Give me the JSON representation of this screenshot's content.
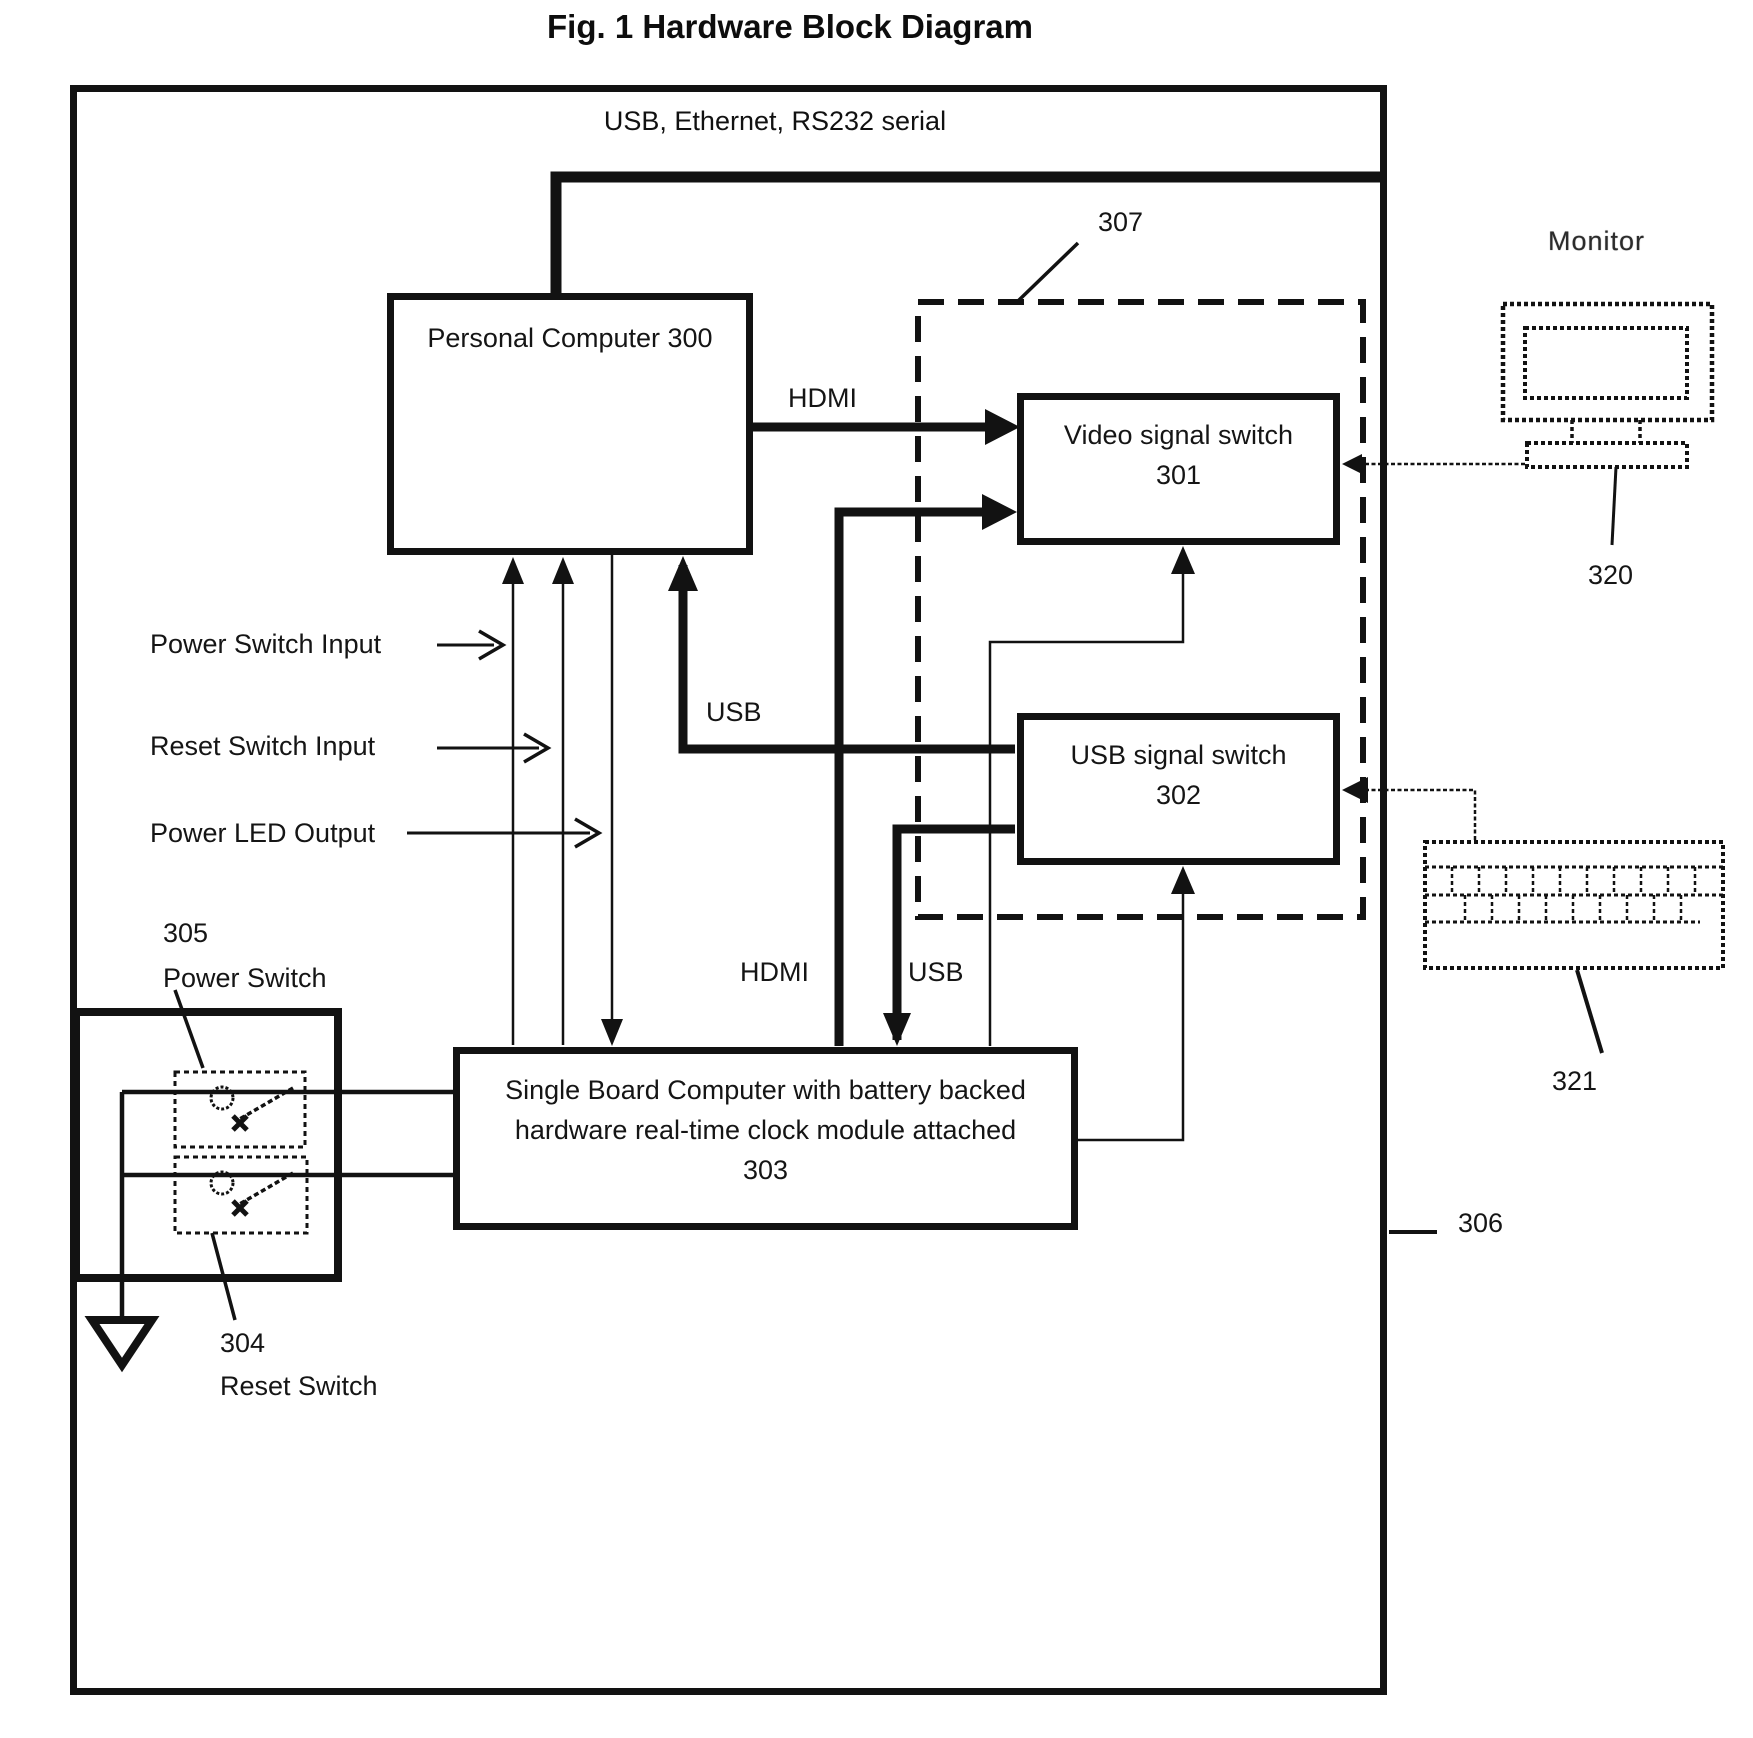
{
  "figure": {
    "title": "Fig. 1 Hardware Block Diagram",
    "top_bus_label": "USB, Ethernet,  RS232 serial"
  },
  "boxes": {
    "personal_computer": {
      "label": "Personal Computer 300"
    },
    "video_switch": {
      "line1": "Video signal switch",
      "line2": "301"
    },
    "usb_switch": {
      "line1": "USB signal switch",
      "line2": "302"
    },
    "sbc": {
      "line1": "Single Board Computer with battery backed",
      "line2": "hardware real-time clock module attached",
      "line3": "303"
    }
  },
  "labels": {
    "hdmi_pc": "HDMI",
    "usb_pc": "USB",
    "hdmi_sbc": "HDMI",
    "usb_sbc": "USB",
    "power_switch_input": "Power Switch Input",
    "reset_switch_input": "Reset Switch Input",
    "power_led_output": "Power LED Output",
    "monitor": "Monitor",
    "power_switch": "Power Switch",
    "reset_switch": "Reset Switch",
    "ref_304": "304",
    "ref_305": "305",
    "ref_306": "306",
    "ref_307": "307",
    "ref_320": "320",
    "ref_321": "321"
  },
  "colors": {
    "ink": "#121212",
    "background": "#ffffff"
  }
}
